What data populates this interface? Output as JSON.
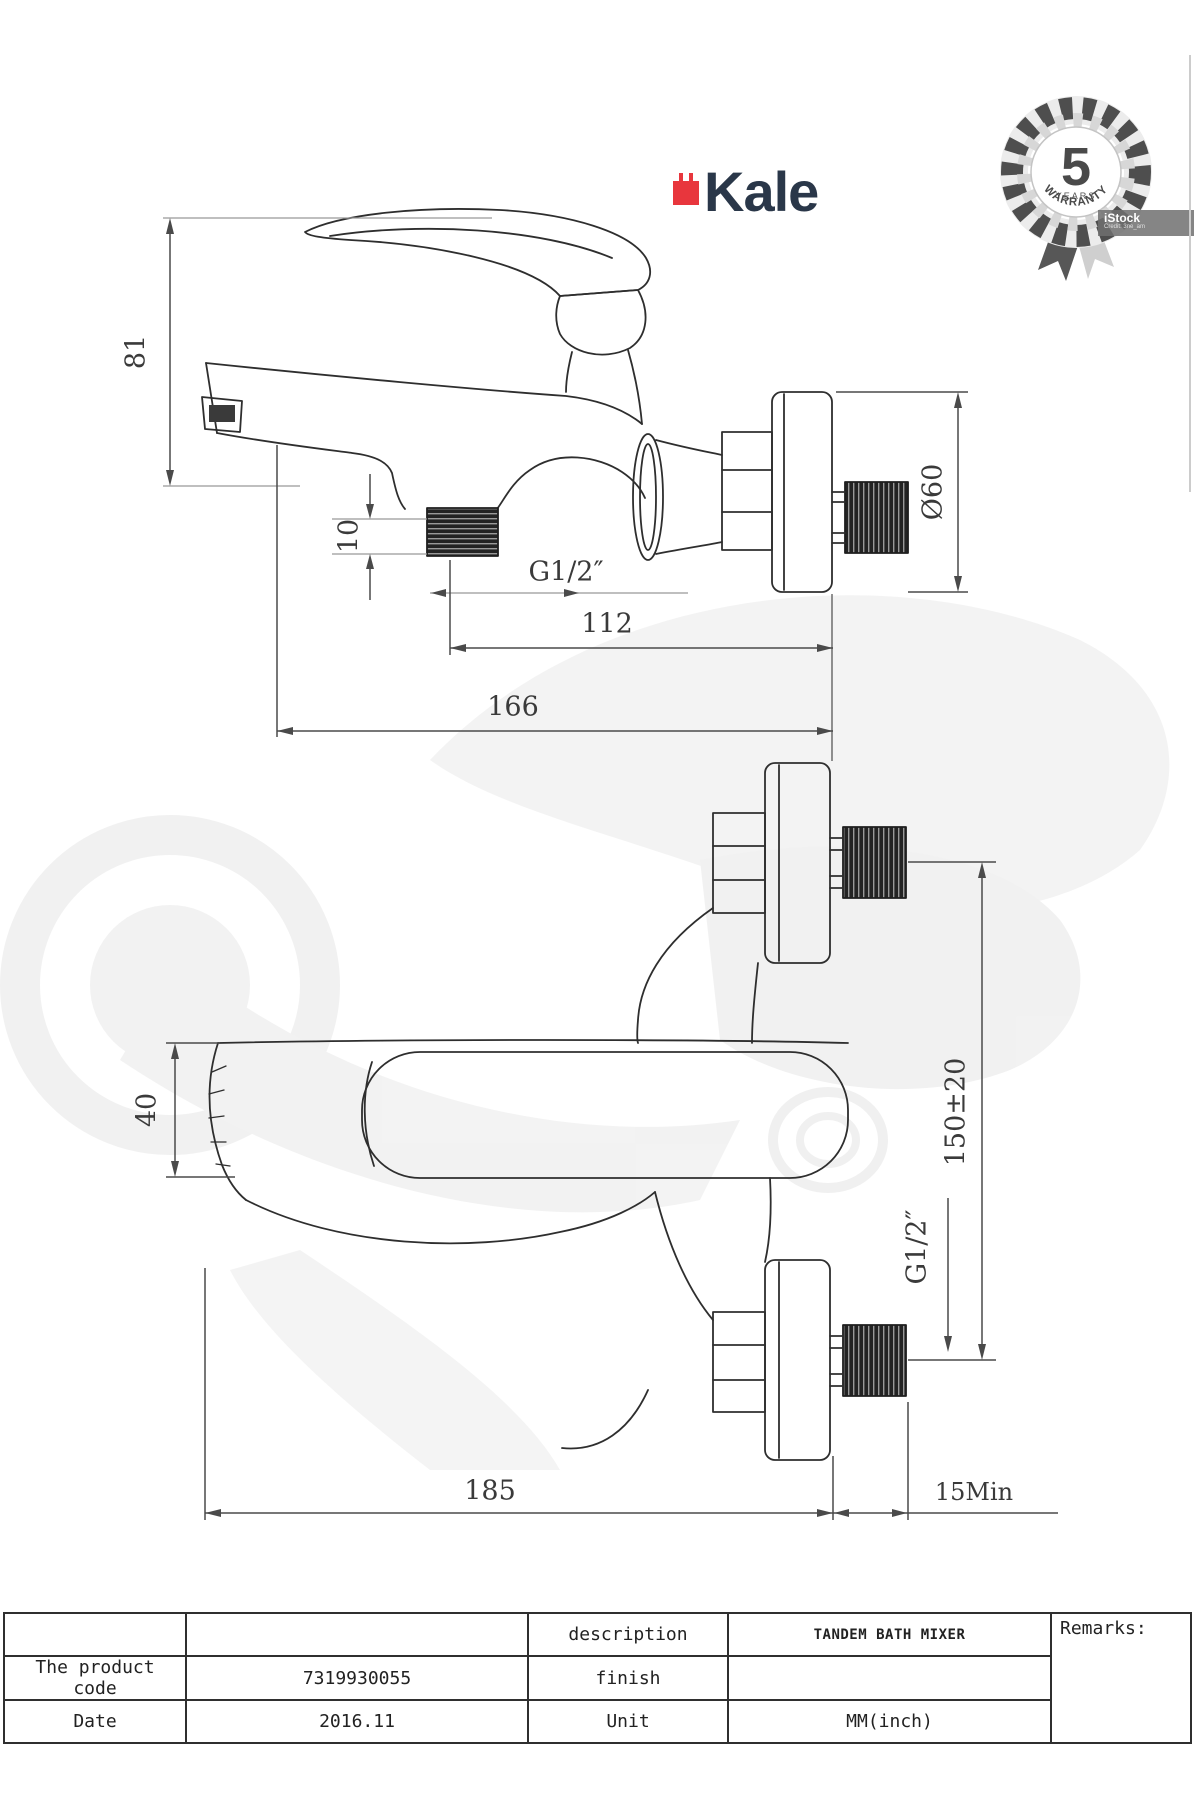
{
  "brand": {
    "wordmark": "Kale"
  },
  "badge": {
    "number": "5",
    "line1": "YEARS",
    "line2": "WARRANTY"
  },
  "stock": {
    "label": "iStock",
    "credit": "Credit: 3ne_am"
  },
  "dims_side": {
    "height": "81",
    "thread_length": "10",
    "thread_size": "G1/2″",
    "depth_to_outlet": "112",
    "depth_total": "166",
    "flange_diameter": "Ø60"
  },
  "dims_front": {
    "handle_width": "40",
    "center_distance": "150±20",
    "thread_size": "G1/2″",
    "total_width": "185",
    "wall_min": "15Min"
  },
  "table": {
    "remarks_label": "Remarks:",
    "rows": [
      {
        "c1": "",
        "c2": "",
        "c3": "description",
        "c4": "TANDEM BATH MIXER"
      },
      {
        "c1": "The product code",
        "c2": "7319930055",
        "c3": "finish",
        "c4": ""
      },
      {
        "c1": "Date",
        "c2": "2016.11",
        "c3": "Unit",
        "c4": "MM(inch)"
      }
    ]
  }
}
